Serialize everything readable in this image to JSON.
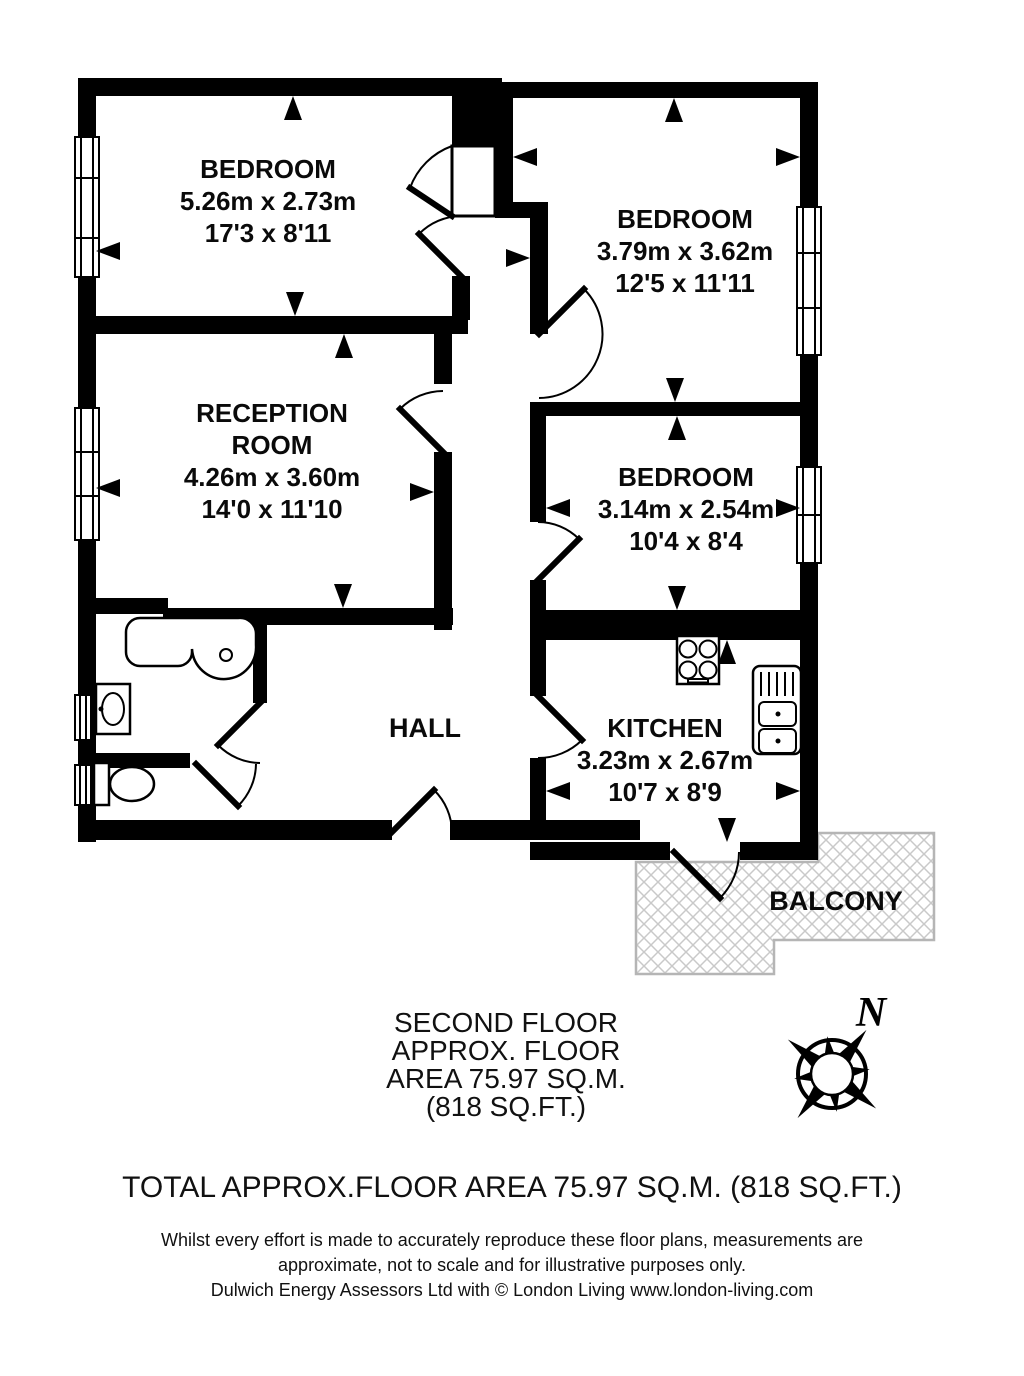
{
  "plan": {
    "rooms": {
      "bed1": {
        "name": "BEDROOM",
        "metric": "5.26m x 2.73m",
        "imperial": "17'3 x 8'11"
      },
      "bed2": {
        "name": "BEDROOM",
        "metric": "3.79m x 3.62m",
        "imperial": "12'5 x 11'11"
      },
      "reception": {
        "name": "RECEPTION",
        "name2": "ROOM",
        "metric": "4.26m x 3.60m",
        "imperial": "14'0 x 11'10"
      },
      "bed3": {
        "name": "BEDROOM",
        "metric": "3.14m x 2.54m",
        "imperial": "10'4 x 8'4"
      },
      "kitchen": {
        "name": "KITCHEN",
        "metric": "3.23m x 2.67m",
        "imperial": "10'7 x 8'9"
      },
      "hall": {
        "name": "HALL"
      },
      "balcony": {
        "name": "BALCONY"
      }
    },
    "compass": {
      "north_label": "N"
    }
  },
  "caption": {
    "line1": "SECOND FLOOR",
    "line2": "APPROX. FLOOR",
    "line3": "AREA 75.97 SQ.M.",
    "line4": "(818 SQ.FT.)"
  },
  "total_line": "TOTAL APPROX.FLOOR AREA 75.97 SQ.M. (818 SQ.FT.)",
  "disclaimer": {
    "line1": "Whilst every effort is made to accurately reproduce these floor plans, measurements are",
    "line2": "approximate, not to scale and for illustrative purposes only.",
    "line3": "Dulwich Energy Assessors Ltd with © London Living www.london-living.com"
  },
  "colors": {
    "wall": "#000000",
    "hatch": "#c9c9c9",
    "hatch_border": "#b5b5b5",
    "text": "#111111"
  }
}
